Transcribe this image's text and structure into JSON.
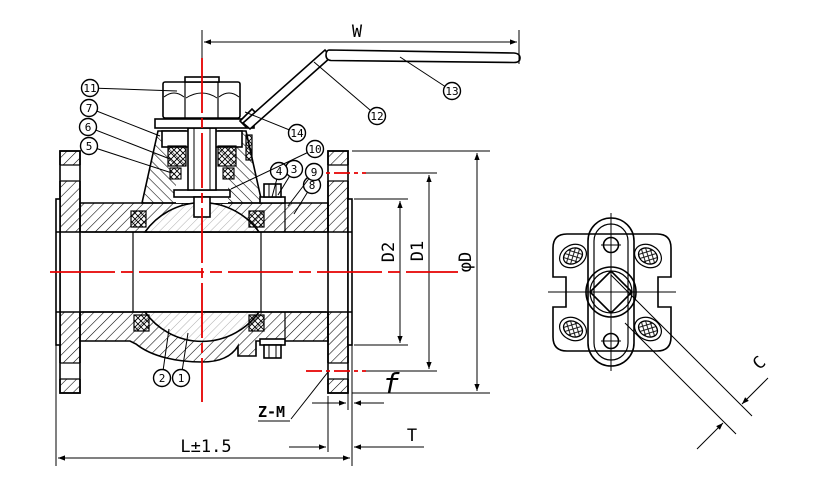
{
  "dims": {
    "W": "W",
    "D2": "D2",
    "D1": "D1",
    "phiD": "φD",
    "L": "L±1.5",
    "T": "T",
    "f": "f",
    "ZM": "Z-M",
    "C": "C"
  },
  "callouts": {
    "c1": "1",
    "c2": "2",
    "c3": "3",
    "c4": "4",
    "c5": "5",
    "c6": "6",
    "c7": "7",
    "c8": "8",
    "c9": "9",
    "c10": "10",
    "c11": "11",
    "c12": "12",
    "c13": "13",
    "c14": "14"
  },
  "colors": {
    "line": "#000000",
    "centerline": "#e60000",
    "ball_hatch": "#9a9a9a",
    "background": "#ffffff"
  }
}
